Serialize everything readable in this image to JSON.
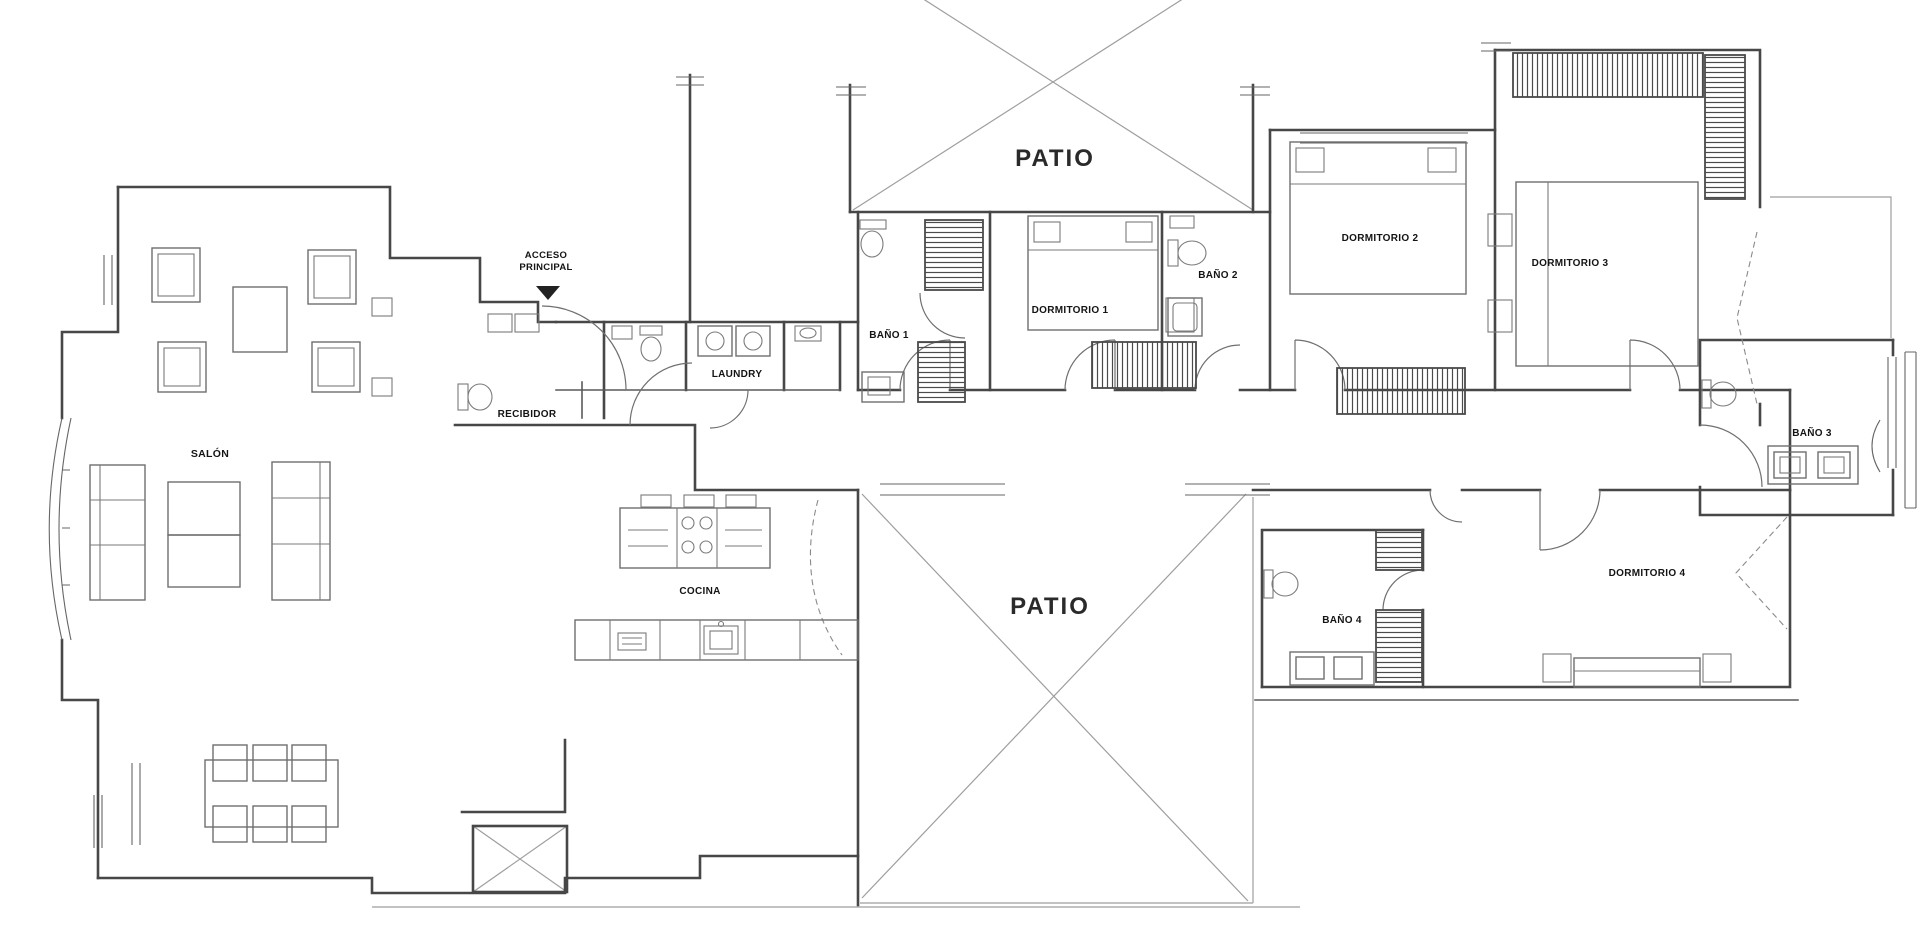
{
  "title": "apartment-floor-plan",
  "colors": {
    "background": "#ffffff",
    "wall": "#474747",
    "furniture": "#6e6e6e",
    "light_lines": "#9e9e9e",
    "label_text": "#141414"
  },
  "entrance": {
    "label_line1": "ACCESO",
    "label_line2": "PRINCIPAL",
    "arrow_icon": "triangle-down"
  },
  "labels": [
    {
      "id": "acceso-line1",
      "text": "ACCESO",
      "x": 546,
      "y": 258,
      "size": 9.5,
      "big": false
    },
    {
      "id": "acceso-line2",
      "text": "PRINCIPAL",
      "x": 546,
      "y": 270,
      "size": 9.5,
      "big": false
    },
    {
      "id": "salon",
      "text": "SALÓN",
      "x": 210,
      "y": 457,
      "size": 10.5,
      "big": false
    },
    {
      "id": "recibidor",
      "text": "RECIBIDOR",
      "x": 527,
      "y": 417,
      "size": 10,
      "big": false
    },
    {
      "id": "laundry",
      "text": "LAUNDRY",
      "x": 737,
      "y": 377,
      "size": 10,
      "big": false
    },
    {
      "id": "cocina",
      "text": "COCINA",
      "x": 700,
      "y": 594,
      "size": 10,
      "big": false
    },
    {
      "id": "bano-1",
      "text": "BAÑO 1",
      "x": 889,
      "y": 338,
      "size": 10,
      "big": false
    },
    {
      "id": "dormitorio-1",
      "text": "DORMITORIO 1",
      "x": 1070,
      "y": 313,
      "size": 10,
      "big": false
    },
    {
      "id": "bano-2",
      "text": "BAÑO 2",
      "x": 1218,
      "y": 278,
      "size": 10,
      "big": false
    },
    {
      "id": "dormitorio-2",
      "text": "DORMITORIO 2",
      "x": 1380,
      "y": 241,
      "size": 10,
      "big": false
    },
    {
      "id": "dormitorio-3",
      "text": "DORMITORIO 3",
      "x": 1570,
      "y": 266,
      "size": 10,
      "big": false
    },
    {
      "id": "bano-3",
      "text": "BAÑO 3",
      "x": 1812,
      "y": 436,
      "size": 10,
      "big": false
    },
    {
      "id": "bano-4",
      "text": "BAÑO 4",
      "x": 1342,
      "y": 623,
      "size": 10,
      "big": false
    },
    {
      "id": "dormitorio-4",
      "text": "DORMITORIO 4",
      "x": 1647,
      "y": 576,
      "size": 10,
      "big": false
    },
    {
      "id": "patio-top",
      "text": "PATIO",
      "x": 1055,
      "y": 166,
      "size": 24,
      "big": true
    },
    {
      "id": "patio-bottom",
      "text": "PATIO",
      "x": 1050,
      "y": 614,
      "size": 24,
      "big": true
    }
  ],
  "rooms_summary": {
    "bedrooms": 4,
    "bathrooms": 4,
    "patios": 2
  }
}
